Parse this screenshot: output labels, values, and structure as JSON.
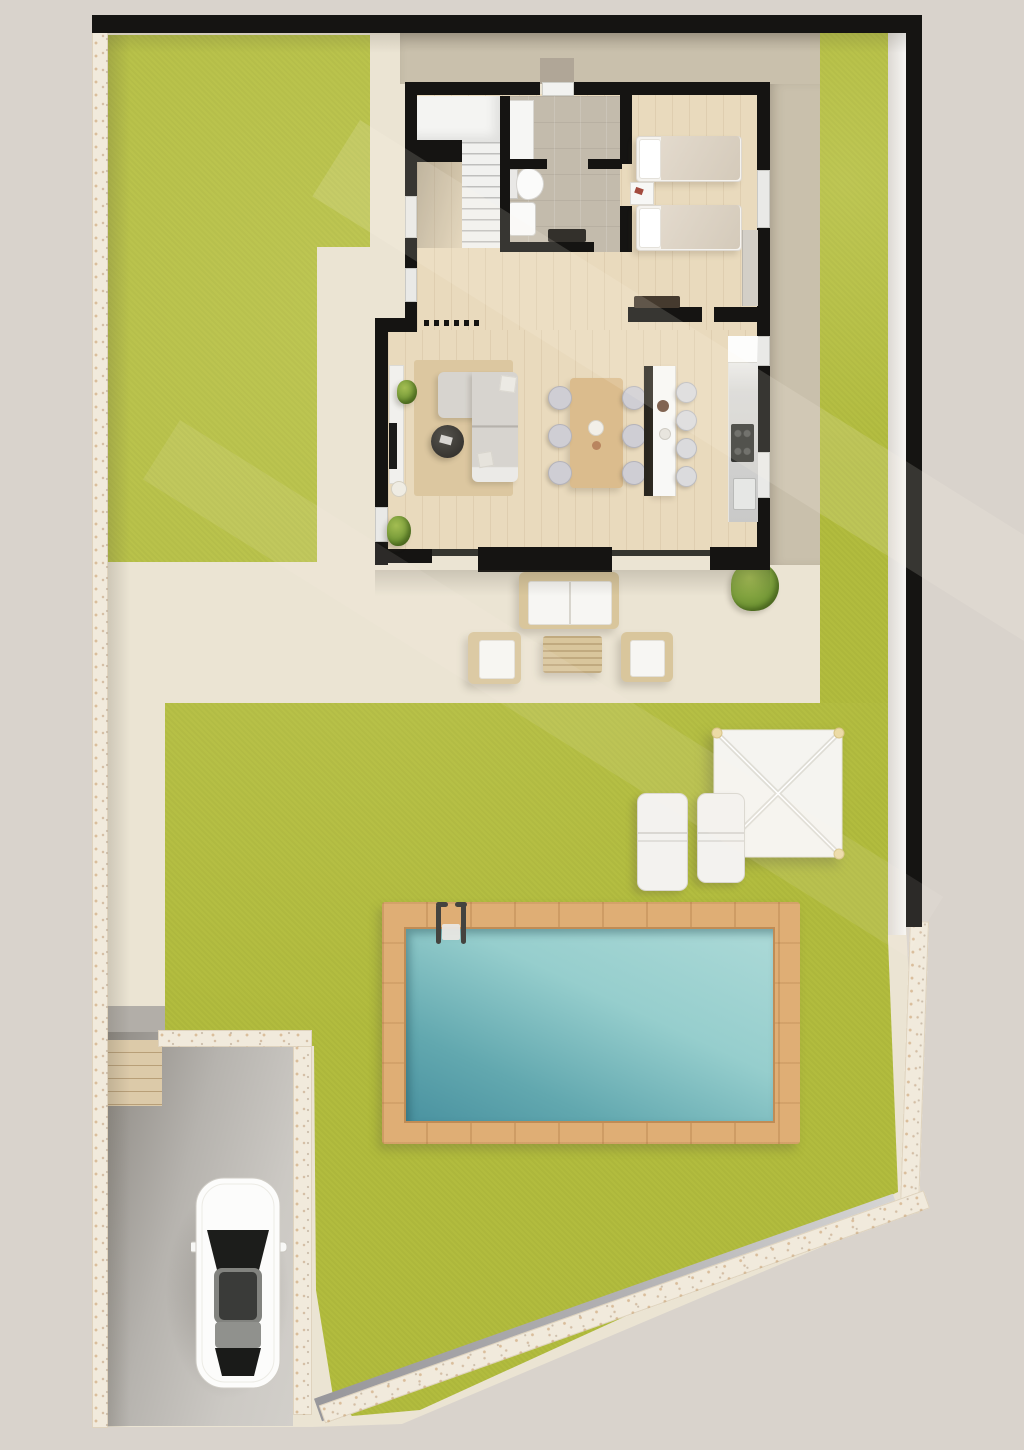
{
  "title": "villa-ground-floor-site-plan",
  "colors": {
    "bg": "#d9d3cc",
    "cream": "#ebe4d3",
    "taupe": "#c9c0ac",
    "grass": "#b2bc3e",
    "stone": "#f1eadc",
    "wallBlack": "#151412",
    "wood": "#e9dabd",
    "tile": "#c3bbac",
    "rug": "#dcc7a0",
    "sofa": "#d7d4cf",
    "tableWood": "#dbbc8d",
    "rattan": "#d9c69c",
    "deck": "#dfae75",
    "waterLight": "#a9d8d6",
    "waterDark": "#4a92a0",
    "pathGray": "#a8a7a9",
    "driveway": "#c6c3bf",
    "canopy": "#f5f4f0",
    "plantGreen": "#6f9434"
  },
  "site": {
    "boundary": {
      "walls": [
        "top-black-wall",
        "right-black-wall",
        "left-stone-wall",
        "right-stone-wall",
        "diagonal-stone-wall",
        "driveway-stone-wall",
        "driveway-stone-wall-cap"
      ]
    },
    "garden": {
      "areas": [
        "front-lawn",
        "main-lawn",
        "side-grass-strip",
        "patio",
        "gravel-strip",
        "concrete-path",
        "driveway",
        "garden-steps",
        "back-terrace",
        "side-terrace"
      ],
      "pool": {
        "features": [
          "wood-deck",
          "water",
          "ladder"
        ]
      },
      "furniture": [
        "outdoor-sofa",
        "outdoor-armchair-left",
        "outdoor-armchair-right",
        "outdoor-coffee-table",
        "sun-lounger-left",
        "sun-lounger-right",
        "pergola-canopy",
        "bush"
      ],
      "vehicle": "white-car-top-view"
    },
    "house": {
      "rooms": [
        "entry-hall",
        "bathroom",
        "bedroom",
        "staircase",
        "living-room",
        "dining-area",
        "kitchen"
      ],
      "furniture": [
        "l-shaped-sofa",
        "round-coffee-table",
        "tv-unit",
        "area-rug",
        "dining-table",
        "six-dining-chairs",
        "kitchen-island",
        "four-bar-stools",
        "kitchen-counter",
        "two-single-beds",
        "nightstand",
        "bedroom-bench",
        "wardrobe",
        "toilet",
        "washbasin",
        "shower-column"
      ]
    }
  }
}
